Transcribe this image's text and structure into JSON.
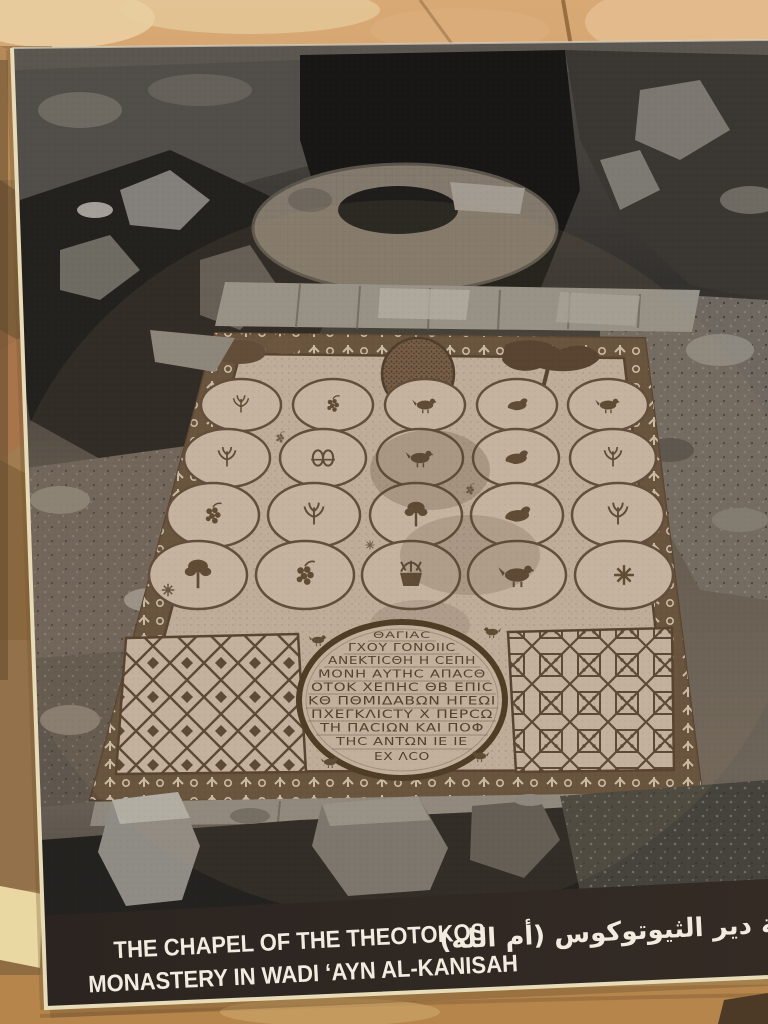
{
  "scene": {
    "description": "Photograph of an interpretive sign panel mounted on a rough tan limestone rock wall",
    "colors": {
      "wall_tan": "#c89a68",
      "wall_highlight": "#ecd4a8",
      "wall_shadow": "#8a6038",
      "poster_edge": "#e8dbb8",
      "caption_band": "#2b2521",
      "caption_text": "#f2ece0",
      "mosaic_ground": "#c2b09f",
      "mosaic_dark": "#57432f"
    }
  },
  "poster": {
    "photo": {
      "kind": "black-and-white excavation photograph",
      "subject": "mosaic pavement of the excavated chapel seen from above, ringed by bedrock walls, an apse platform and rubble"
    },
    "inscription": {
      "lines": [
        "ΘΑΓΙΑC",
        "ΓΧΟΥ ΓΟΝΟΙΙC",
        "ΑΝΕΚΤΙCΘΗ Η CΕΠΗ",
        "ΜΟΝΗ ΑΥΤΗC ΑΠΑCΘ",
        "ΟΤΟΚ ΧΕΠΗC ΘΒ ΕΠΙC",
        "ΚΘ ΠΘΜΙΔΑΒΩΝ ΗΓΕΩΙ",
        "ΠΧΕΓΚΛΙCΤΥ Χ ΠΕΡCΩ",
        "ΤΗ ΠΑCΙΩΝ ΚΑΙ ΠΟΦ",
        "ΤΗC ΑΝΤΩΝ ΙΕ ΙΕ",
        "ΕΧ ΛCΟ"
      ]
    },
    "caption": {
      "english_line1": "THE CHAPEL OF THE THEOTOKOS",
      "english_line2": "MONASTERY IN WADI ‘AYN AL-KANISAH",
      "arabic": "كنيسة دير الثيوتوكوس (أم الله)"
    }
  }
}
